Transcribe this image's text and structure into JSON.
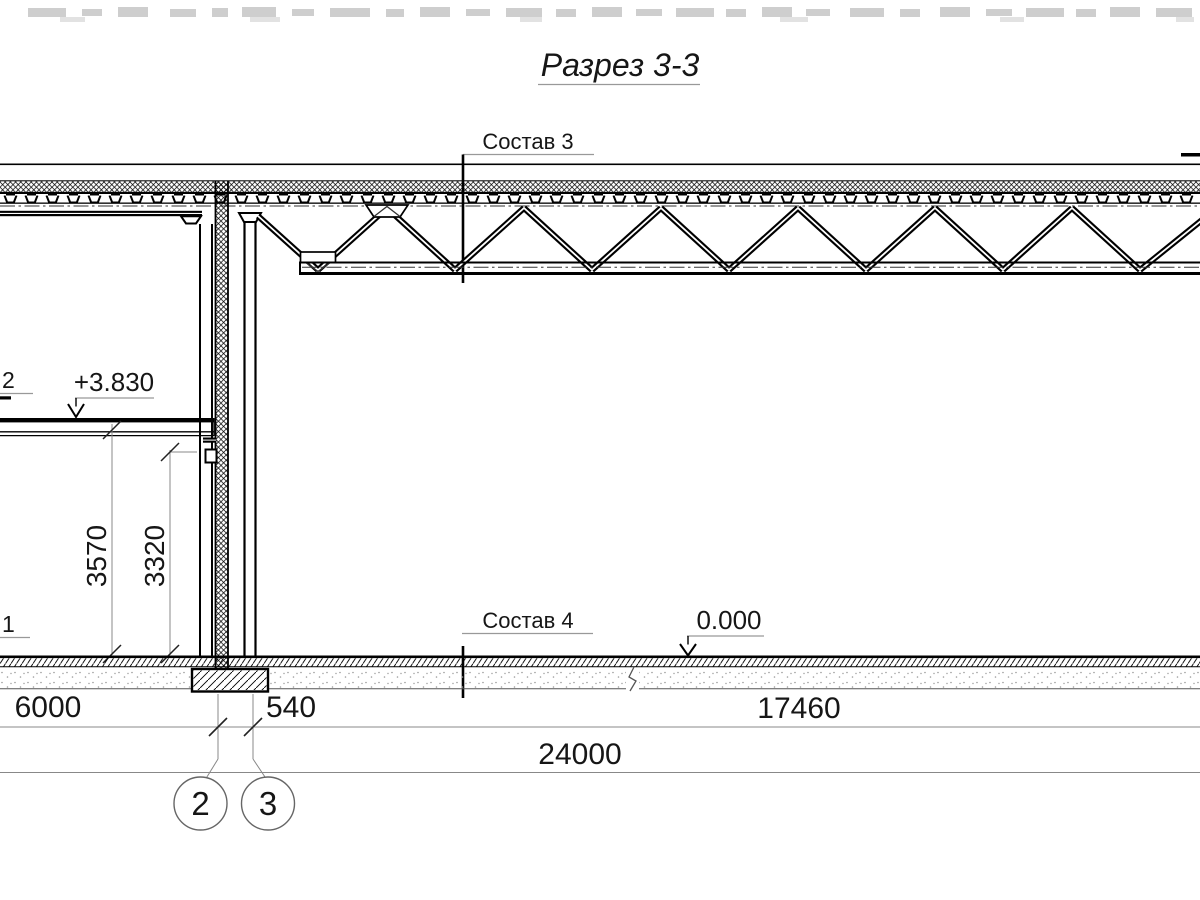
{
  "drawing": {
    "title": "Разрез 3-3",
    "section_marks": {
      "sostav_3": "Состав 3",
      "sostav_4": "Состав 4",
      "sostav_2_partial": "2",
      "sostav_1_partial": "1"
    },
    "elevation_marks": {
      "mezzanine_level": "+3.830",
      "ground_level": "0.000"
    },
    "dimensions": {
      "span_left": "6000",
      "wall_offset": "540",
      "span_right": "17460",
      "total": "24000",
      "height_floor_to_slab": "3570",
      "height_floor_to_beam": "3320"
    },
    "grid_axes": {
      "axis_2": "2",
      "axis_3": "3"
    }
  }
}
